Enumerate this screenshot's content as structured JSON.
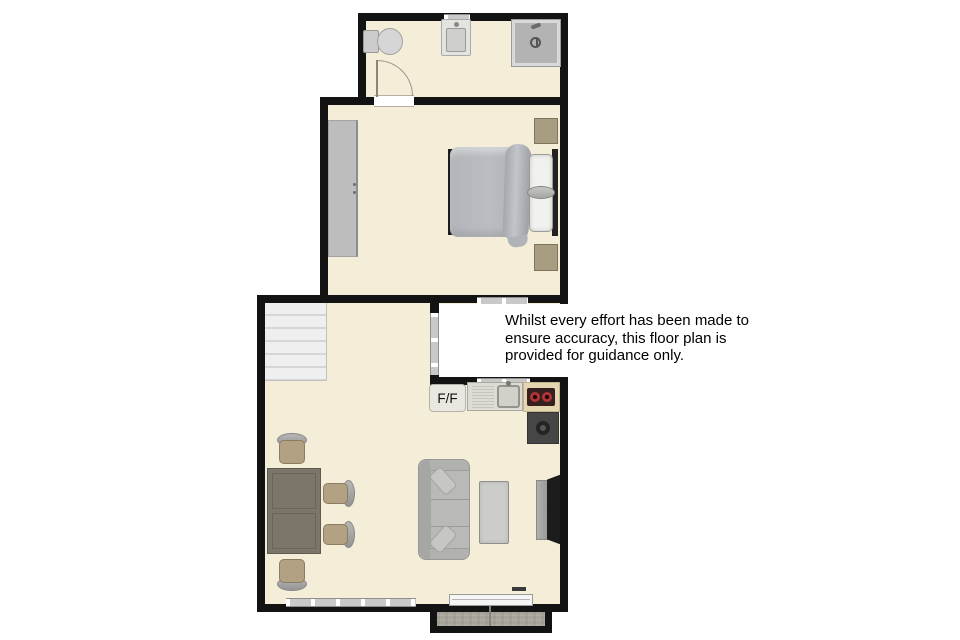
{
  "floorplan": {
    "disclaimer": {
      "lines": [
        "Whilst every effort has been made to",
        "ensure accuracy, this floor plan is",
        "provided for guidance only."
      ]
    },
    "labels": {
      "fridge_freezer": "F/F"
    },
    "colors": {
      "wall": "#131313",
      "floor": "#f4edd8",
      "window_frame": "#c9c9c9",
      "stairs": "#ededed",
      "wardrobe": "#bdbdbd",
      "bed_duvet": "#b6b9bd",
      "pillow": "#f1f1ef",
      "nightstand": "#a89d81",
      "dining_table": "#7c766a",
      "chair_seat": "#b3a183",
      "chair_back": "#a9a9a7",
      "sofa": "#b9b9b7",
      "coffee_table": "#cccccb",
      "tv_screen": "#1c1c1c",
      "counter": "#e5d6b2",
      "hob": "#351f1f",
      "burner_red": "#b23434",
      "appliance": "#464646",
      "porch_floor": "#a8a49b",
      "disclaimer_bg": "#ffffff",
      "disclaimer_text": "#000000"
    }
  }
}
